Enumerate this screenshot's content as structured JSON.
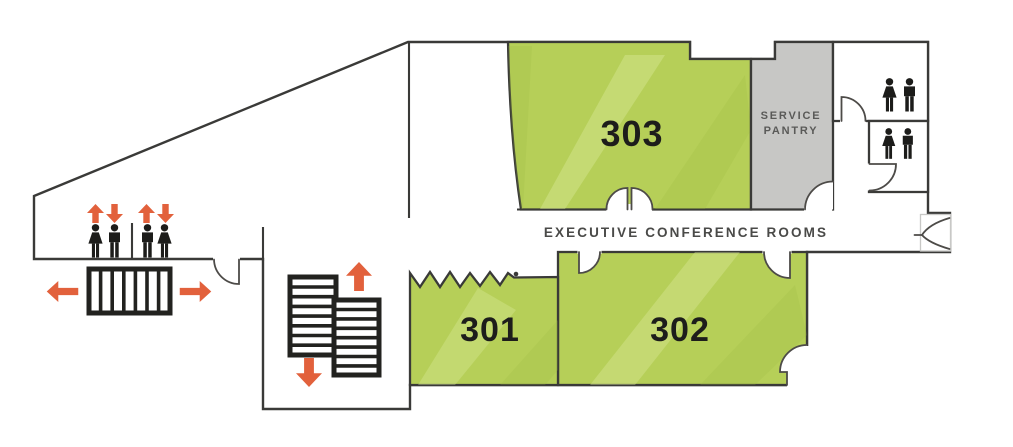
{
  "colors": {
    "room_green": "#b6cf58",
    "room_green_light": "#d9e79c",
    "room_green_dark": "#9dba41",
    "pantry_gray": "#c7c7c5",
    "wall_dark": "#3a3a38",
    "icon_black": "#1c1c1a",
    "arrow_orange": "#e2613c",
    "room_label": "#1d1d1b",
    "corridor_label": "#4a4a48",
    "pantry_label": "#5a5a58"
  },
  "rooms": {
    "room_301": {
      "label": "301"
    },
    "room_302": {
      "label": "302"
    },
    "room_303": {
      "label": "303"
    },
    "service_pantry": {
      "label_line1": "SERVICE",
      "label_line2": "PANTRY"
    }
  },
  "corridor": {
    "label": "EXECUTIVE CONFERENCE ROOMS"
  },
  "icons": {
    "elevator_lobby": [
      "up-arrow",
      "down-arrow",
      "woman-figure",
      "man-figure"
    ],
    "escalator": [
      "left-arrow",
      "right-arrow"
    ],
    "stairs": [
      "up-arrow",
      "down-arrow"
    ],
    "restrooms": [
      "woman-figure",
      "man-figure"
    ]
  }
}
